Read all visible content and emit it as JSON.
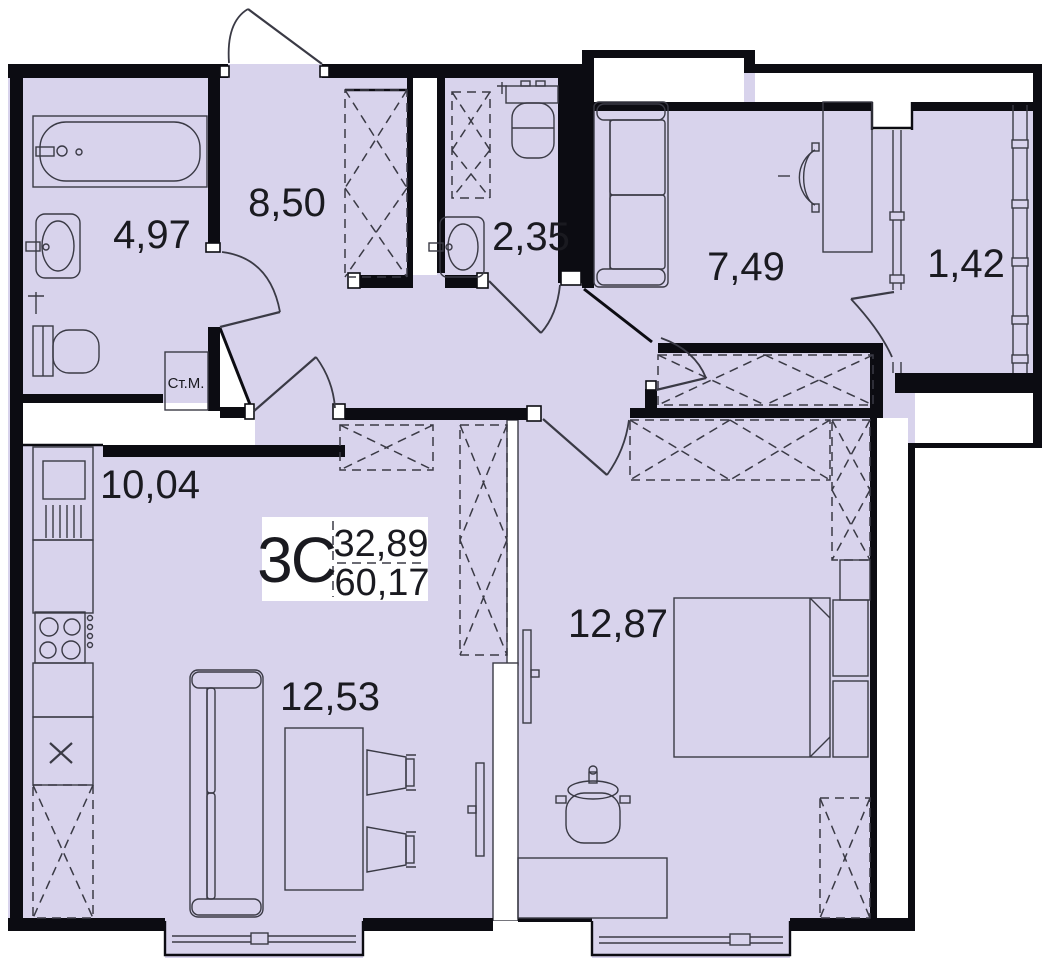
{
  "plan": {
    "type_label": "3C",
    "upper_area": "32,89",
    "lower_area": "60,17",
    "rooms": {
      "bathroom": "4,97",
      "hall": "8,50",
      "wc": "2,35",
      "study": "7,49",
      "balcony": "1,42",
      "kitchen": "10,04",
      "living": "12,53",
      "bedroom": "12,87"
    },
    "labels": {
      "washing_machine": "Ст.М."
    },
    "colors": {
      "floor": "#D8D3EC",
      "wall": "#0C0C12",
      "line": "#3A3A45",
      "bg": "#FFFFFF",
      "text": "#1A1A20"
    }
  }
}
